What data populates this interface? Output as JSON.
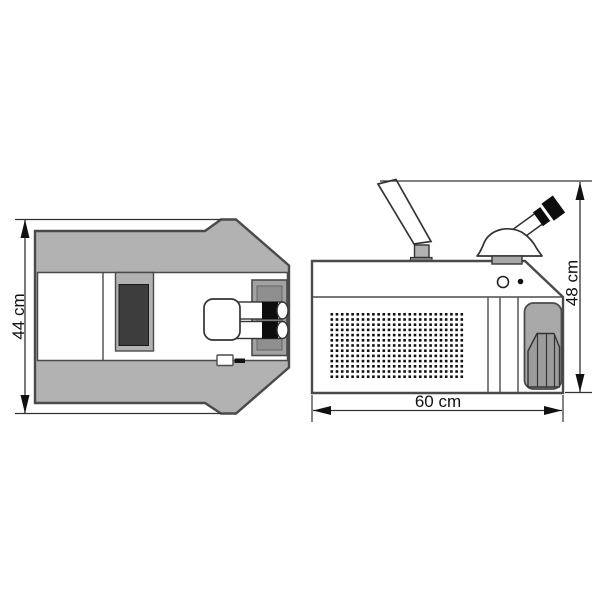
{
  "page": {
    "background": "#ffffff",
    "description": "Technical dimension drawing of a benchtop laser welding machine, top view and side view"
  },
  "diagram": {
    "type": "technical-drawing",
    "views": {
      "top_view": {
        "label": "top-view",
        "dimension_label": "44 cm"
      },
      "side_view": {
        "label": "side-view",
        "height_label": "48 cm",
        "width_label": "60 cm",
        "grille": {
          "rows": 13,
          "cols": 26
        }
      }
    },
    "colors": {
      "body_gray": "#b2b2b2",
      "outline": "#4a4a4a",
      "thin_line": "#333333",
      "dark_panel": "#3d3d3d",
      "recess_gray": "#8f8f8f",
      "handle_gray": "#a9a9a9",
      "black": "#111111",
      "white": "#ffffff"
    }
  }
}
